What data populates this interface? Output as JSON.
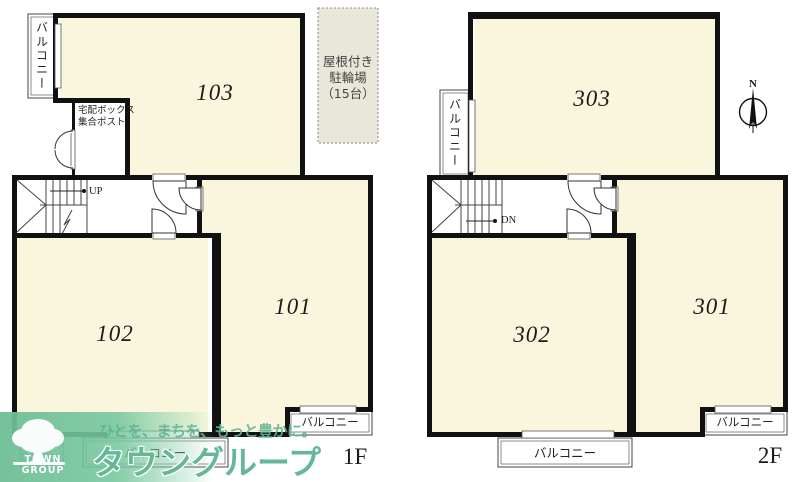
{
  "floor1": {
    "label": "1F",
    "room_101": "101",
    "room_102": "102",
    "room_103": "103",
    "balcony_left": "バルコニー",
    "balcony_bottom": "バルコニー",
    "balcony_right": "バルコニー",
    "delivery_line1": "宅配ボックス",
    "delivery_line2": "集合ポスト",
    "dust_line1": "ダスト",
    "dust_line2": "ボックス",
    "stair_direction": "UP",
    "bike_line1": "屋根付き",
    "bike_line2": "駐輪場",
    "bike_line3": "（15台）"
  },
  "floor2": {
    "label": "2F",
    "room_301": "301",
    "room_302": "302",
    "room_303": "303",
    "balcony_left": "バルコニー",
    "balcony_bottom": "バルコニー",
    "balcony_right": "バルコニー",
    "stair_direction": "DN",
    "compass_north": "N"
  },
  "watermark": {
    "tagline": "ひとを、まちを、もっと豊かに。",
    "brand": "タウングループ",
    "logo_caption": "TOWN GROUP"
  },
  "colors": {
    "room_fill": "#FAF6DD",
    "bike_fill": "#E9E6DA",
    "wall": "#111111",
    "watermark_green": "#5CB492"
  }
}
